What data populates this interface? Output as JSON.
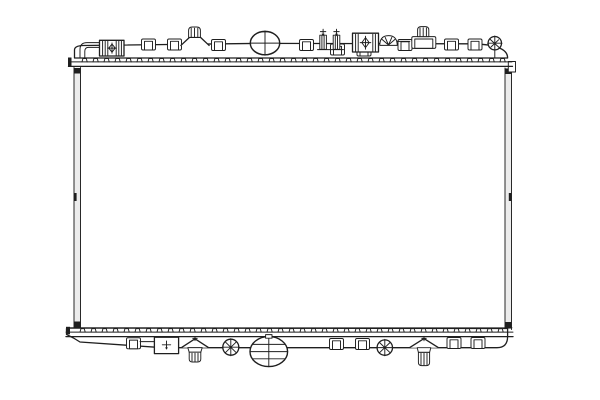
{
  "canvas": {
    "width": 600,
    "height": 400,
    "background": "#ffffff",
    "ink": "#1f1f1f",
    "shade": "#ececec"
  },
  "illustration": {
    "kind": "technical line drawing",
    "subject": "engine cooling radiator, front view",
    "text_content": "",
    "components": [
      "top tank with crimped header seam",
      "inlet pipe connector with hatched unions",
      "filler cap",
      "mounting studs (top left, top right)",
      "clip tabs along both headers",
      "thermo-switch fitting with two bolts",
      "bracket connector",
      "spring clip",
      "screw heads / screw plugs",
      "radiator core with side plates",
      "bottom tank with drain plate",
      "push-pin mounts (bottom)",
      "outlet port (bottom centre)"
    ]
  },
  "drawing": {
    "teeth": {
      "top": {
        "x0": 82,
        "x1": 500,
        "step": 11.0,
        "y": 61.9,
        "w": 5.2,
        "h": 3.4
      },
      "bottom": {
        "x0": 80,
        "x1": 503,
        "step": 11.0,
        "y": 332.1,
        "w": 5.2,
        "h": 3.4
      }
    },
    "tabs": {
      "top": [
        {
          "x": 141.5,
          "y": 39.0
        },
        {
          "x": 167.5,
          "y": 39.0
        },
        {
          "x": 211.5,
          "y": 39.5
        },
        {
          "x": 299.5,
          "y": 39.5
        },
        {
          "x": 330.5,
          "y": 44.0
        },
        {
          "x": 357.0,
          "y": 45.0
        },
        {
          "x": 398.0,
          "y": 39.5
        },
        {
          "x": 444.5,
          "y": 39.0
        },
        {
          "x": 468.0,
          "y": 39.0
        }
      ],
      "bottom": [
        {
          "x": 126.5,
          "y": 337.8
        },
        {
          "x": 329.5,
          "y": 338.5
        },
        {
          "x": 355.5,
          "y": 338.5
        },
        {
          "x": 447.0,
          "y": 337.5
        },
        {
          "x": 471.0,
          "y": 337.5
        }
      ]
    }
  }
}
